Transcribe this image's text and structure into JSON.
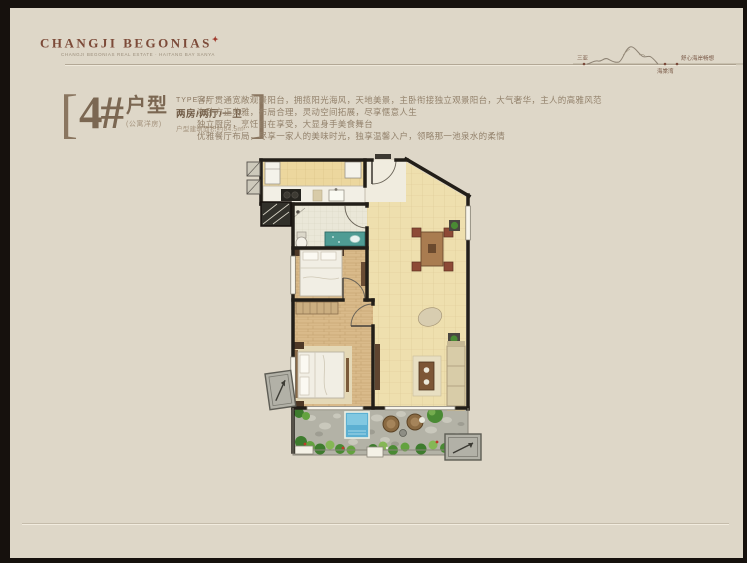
{
  "brand": {
    "logo": "CHANGJI BEGONIAS",
    "logo_mark": "✦",
    "tagline": "CHANGJI BEGONIAS REAL ESTATE · HAITANG BAY SANYA"
  },
  "map_sketch": {
    "left_label": "三亚",
    "peak_label": "海棠湾",
    "right_label": "舒心海岸畅想"
  },
  "unit": {
    "bracket_left": "[",
    "bracket_right": "]",
    "number": "4#",
    "type_word": "户型",
    "subtitle": "(公寓洋房)",
    "type_en": "TYPE 4#",
    "layout": "两房/两厅/一卫",
    "area": "户型建筑面积约84.5m²"
  },
  "description": {
    "line1": "客厅贯通宽敞观景阳台，拥揽阳光海风，天地美景，主卧衔接独立观景阳台，大气奢华，主人的高雅风范",
    "line2": "次卧方正典雅，布局合理，灵动空间拓展，尽享惬意人生",
    "line3": "独立厨房，烹饪自在享受，大显身手美食舞台",
    "line4": "优雅餐厅布局，尽享一家人的美味时光，独享温馨入户，领略那一池泉水的柔情"
  },
  "colors": {
    "page_bg": "#ded7c8",
    "frame": "#16110d",
    "brand": "#7c4a38",
    "accent_red": "#a03b2e",
    "title_text": "#7b6752",
    "body_text": "#93826c",
    "floor_tile": "#ecd79e",
    "wood_floor": "#d9ba8a",
    "wall": "#221e18",
    "garden_green": "#4a8a34",
    "pool_blue": "#5cb0d2",
    "stone": "#b3b2a6"
  }
}
